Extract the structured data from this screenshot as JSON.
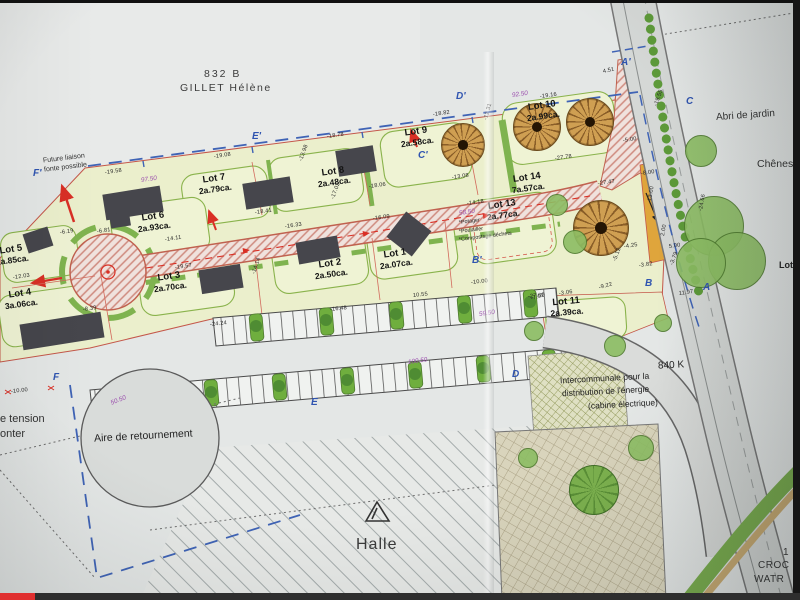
{
  "player": {
    "progress_fraction": 0.044
  },
  "colors": {
    "plan_red": "#c4574a",
    "lot_fill": "#ebefcc",
    "green": "#76ad45",
    "blue_boundary": "#3f63b5",
    "purple_chainage": "#9b4fae",
    "progress_red": "#e02f2f"
  },
  "plan": {
    "header": {
      "parcel_number": "832 B",
      "owner": "GILLET Hélène"
    },
    "labels": {
      "future_liaison_1": "Future liaison",
      "future_liaison_2": "fonte possible",
      "abri": "Abri de jardin",
      "chenes": "Chênes",
      "aire": "Aire de retournement",
      "halle": "Halle",
      "k840": "840 K",
      "inter1": "Intercommunale pour la",
      "inter2": "distribution de l'énergie",
      "inter3": "(cabine électrique)",
      "tension": "e tension",
      "onter": "onter",
      "corner1": "1",
      "corner2": "CROC",
      "corner3": "WATR",
      "lot_cut": "Lot"
    },
    "lots": [
      {
        "name": "Lot 1",
        "area": "2a.07ca.",
        "x": 409,
        "y": 258,
        "r": -8
      },
      {
        "name": "Lot 2",
        "area": "2a.50ca.",
        "x": 344,
        "y": 268,
        "r": -8
      },
      {
        "name": "Lot 3",
        "area": "2a.70ca.",
        "x": 183,
        "y": 281,
        "r": -8
      },
      {
        "name": "Lot 4",
        "area": "3a.06ca.",
        "x": 34,
        "y": 298,
        "r": -8
      },
      {
        "name": "Lot 5",
        "area": "2a.85ca.",
        "x": 25,
        "y": 254,
        "r": -8
      },
      {
        "name": "Lot 6",
        "area": "2a.93ca.",
        "x": 167,
        "y": 221,
        "r": -8
      },
      {
        "name": "Lot 7",
        "area": "2a.79ca.",
        "x": 228,
        "y": 183,
        "r": -8
      },
      {
        "name": "Lot 8",
        "area": "2a.48ca.",
        "x": 347,
        "y": 176,
        "r": -8
      },
      {
        "name": "Lot 9",
        "area": "2a.58ca.",
        "x": 430,
        "y": 136,
        "r": -8
      },
      {
        "name": "Lot 10",
        "area": "2a.99ca.",
        "x": 556,
        "y": 110,
        "r": -8
      },
      {
        "name": "Lot 11",
        "area": "2a.39ca.",
        "x": 580,
        "y": 306,
        "r": -5
      },
      {
        "name": "Lot 13",
        "area": "2a.77ca.",
        "x": 516,
        "y": 209,
        "r": -8
      },
      {
        "name": "Lot 14",
        "area": "7a.57ca.",
        "x": 541,
        "y": 182,
        "r": -8
      }
    ],
    "lot13_amenities": [
      "*Potager",
      "*Poulailler",
      "*Compostage déchets"
    ],
    "markers": [
      {
        "t": "F'",
        "x": 33,
        "y": 168
      },
      {
        "t": "E'",
        "x": 252,
        "y": 131
      },
      {
        "t": "D'",
        "x": 456,
        "y": 91
      },
      {
        "t": "C'",
        "x": 418,
        "y": 150
      },
      {
        "t": "A'",
        "x": 621,
        "y": 57
      },
      {
        "t": "C",
        "x": 686,
        "y": 96
      },
      {
        "t": "B'",
        "x": 472,
        "y": 255
      },
      {
        "t": "B",
        "x": 645,
        "y": 278
      },
      {
        "t": "A",
        "x": 703,
        "y": 282
      },
      {
        "t": "F",
        "x": 53,
        "y": 372
      },
      {
        "t": "E",
        "x": 311,
        "y": 397
      },
      {
        "t": "D",
        "x": 512,
        "y": 369
      }
    ],
    "chainages": [
      {
        "t": "97.50",
        "x": 141,
        "y": 177,
        "r": -8
      },
      {
        "t": "92.50",
        "x": 512,
        "y": 92,
        "r": -8
      },
      {
        "t": "58.50",
        "x": 459,
        "y": 210,
        "r": -8
      },
      {
        "t": "59.50",
        "x": 479,
        "y": 311,
        "r": -8
      },
      {
        "t": "100.50",
        "x": 408,
        "y": 359,
        "r": -8
      },
      {
        "t": "50.50",
        "x": 111,
        "y": 400,
        "r": -22
      }
    ],
    "measurements": [
      {
        "t": "-19.58",
        "x": 105,
        "y": 170,
        "r": -8
      },
      {
        "t": "-19.08",
        "x": 214,
        "y": 154,
        "r": -8
      },
      {
        "t": "-18.78",
        "x": 327,
        "y": 134,
        "r": -8
      },
      {
        "t": "-18.82",
        "x": 433,
        "y": 112,
        "r": -8
      },
      {
        "t": "-19.16",
        "x": 540,
        "y": 94,
        "r": -8
      },
      {
        "t": "-6.19",
        "x": 60,
        "y": 230,
        "r": -8
      },
      {
        "t": "-6.81",
        "x": 97,
        "y": 229,
        "r": -8
      },
      {
        "t": "-12.03",
        "x": 13,
        "y": 275,
        "r": -8
      },
      {
        "t": "-8.39",
        "x": 83,
        "y": 307,
        "r": -8
      },
      {
        "t": "-14.11",
        "x": 165,
        "y": 237,
        "r": -8
      },
      {
        "t": "-17.02",
        "x": 333,
        "y": 196,
        "r": -70
      },
      {
        "t": "-18.41",
        "x": 255,
        "y": 210,
        "r": -8
      },
      {
        "t": "-19.57",
        "x": 175,
        "y": 265,
        "r": -8
      },
      {
        "t": "-14.14",
        "x": 254,
        "y": 271,
        "r": -72
      },
      {
        "t": "-24.24",
        "x": 210,
        "y": 322,
        "r": -6
      },
      {
        "t": "-16.48",
        "x": 330,
        "y": 307,
        "r": -6
      },
      {
        "t": "-16.09",
        "x": 373,
        "y": 216,
        "r": -8
      },
      {
        "t": "-16.33",
        "x": 285,
        "y": 224,
        "r": -8
      },
      {
        "t": "-18.06",
        "x": 369,
        "y": 184,
        "r": -8
      },
      {
        "t": "-13.98",
        "x": 301,
        "y": 158,
        "r": -70
      },
      {
        "t": "-13.08",
        "x": 452,
        "y": 175,
        "r": -8
      },
      {
        "t": "-14.18",
        "x": 467,
        "y": 201,
        "r": -8
      },
      {
        "t": "-27.78",
        "x": 555,
        "y": 156,
        "r": -8
      },
      {
        "t": "-27.47",
        "x": 598,
        "y": 181,
        "r": -8
      },
      {
        "t": "-5.00",
        "x": 623,
        "y": 138,
        "r": -8
      },
      {
        "t": "-8.00",
        "x": 641,
        "y": 171,
        "r": -8
      },
      {
        "t": "13.00",
        "x": 650,
        "y": 198,
        "r": -80
      },
      {
        "t": "2.00",
        "x": 663,
        "y": 233,
        "r": -80
      },
      {
        "t": "5.00",
        "x": 669,
        "y": 244,
        "r": -8
      },
      {
        "t": "-4.25",
        "x": 624,
        "y": 244,
        "r": -8
      },
      {
        "t": "-3.82",
        "x": 639,
        "y": 263,
        "r": -8
      },
      {
        "t": "-5.12",
        "x": 615,
        "y": 258,
        "r": -70
      },
      {
        "t": "-3.79",
        "x": 672,
        "y": 262,
        "r": -70
      },
      {
        "t": "-3.06",
        "x": 559,
        "y": 291,
        "r": -8
      },
      {
        "t": "-9.22",
        "x": 599,
        "y": 285,
        "r": -15
      },
      {
        "t": "11.97",
        "x": 679,
        "y": 291,
        "r": -8
      },
      {
        "t": "-7.02",
        "x": 531,
        "y": 296,
        "r": -15
      },
      {
        "t": "-10.00",
        "x": 471,
        "y": 280,
        "r": -6
      },
      {
        "t": "10.55",
        "x": 413,
        "y": 293,
        "r": -6
      },
      {
        "t": "-27.00",
        "x": 528,
        "y": 294,
        "r": -6
      },
      {
        "t": "-10.00",
        "x": 11,
        "y": 389,
        "r": -6
      },
      {
        "t": "4.51",
        "x": 603,
        "y": 69,
        "r": -12
      },
      {
        "t": "-12.31",
        "x": 486,
        "y": 117,
        "r": -75
      },
      {
        "t": "-19.55",
        "x": 656,
        "y": 103,
        "r": -70
      },
      {
        "t": "-24.66",
        "x": 701,
        "y": 208,
        "r": -80
      }
    ]
  }
}
